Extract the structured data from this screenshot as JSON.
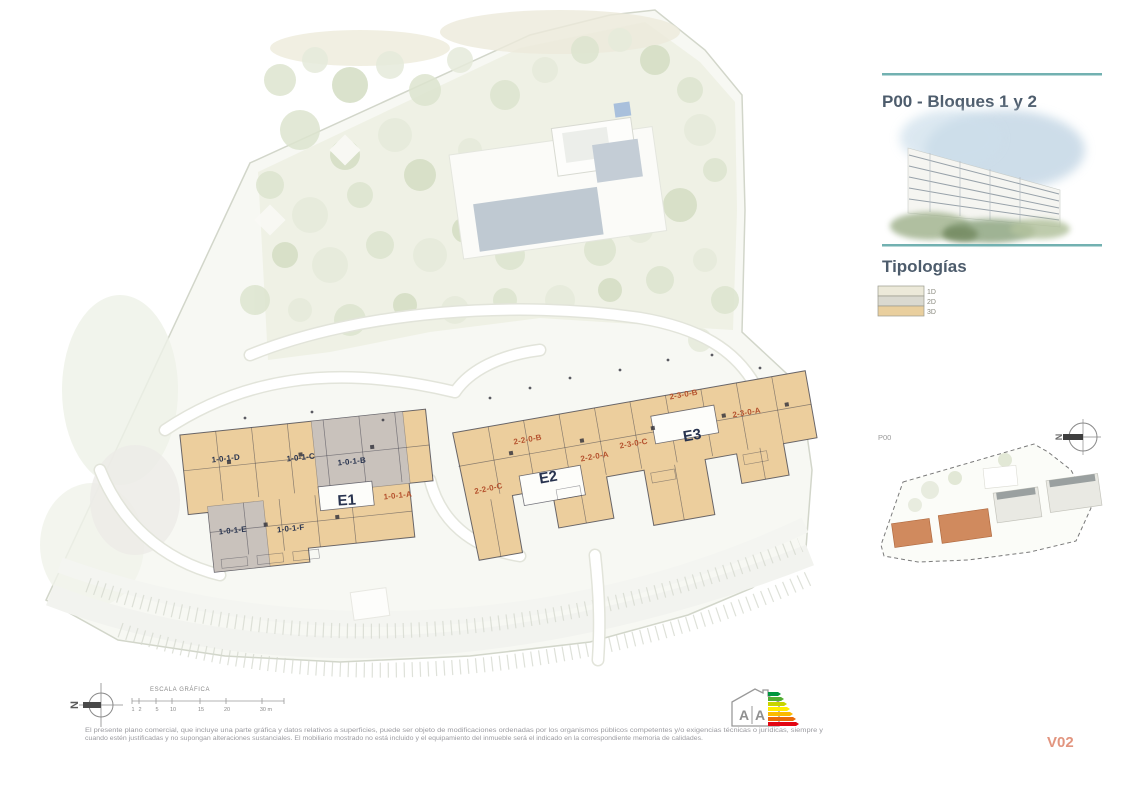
{
  "sheet": {
    "title": "P00 - Bloques 1 y 2",
    "typologies_heading": "Tipologías",
    "legend": [
      {
        "label": "1D",
        "color": "#ece9d9"
      },
      {
        "label": "2D",
        "color": "#dad9d0"
      },
      {
        "label": "3D",
        "color": "#e9cf9e"
      }
    ],
    "locator_label": "P00",
    "compass_letter": "N",
    "version": "V02"
  },
  "plan": {
    "buildings": [
      {
        "name": "E1",
        "units": [
          "1-0-1-D",
          "1-0-1-C",
          "1-0-1-B",
          "1-0-1-A",
          "1-0-1-E",
          "1-0-1-F"
        ]
      },
      {
        "name": "E2",
        "units": [
          "2-2-0-B",
          "2-2-0-A",
          "2-2-0-C"
        ]
      },
      {
        "name": "E3",
        "units": [
          "2-3-0-C",
          "2-3-0-B",
          "2-3-0-A"
        ]
      }
    ]
  },
  "scalebar": {
    "heading": "ESCALA GRÁFICA",
    "ticks": [
      "1",
      "2",
      "5",
      "10",
      "15",
      "20",
      "30 m"
    ]
  },
  "energy": {
    "left_letter": "A",
    "right_letter": "A",
    "colors": [
      "#009640",
      "#52ae32",
      "#c8d400",
      "#ffed00",
      "#fbba00",
      "#eb6909",
      "#e30613"
    ]
  },
  "disclaimer": {
    "line1": "El presente plano comercial, que incluye una parte gráfica y datos relativos a superficies, puede ser objeto de modificaciones ordenadas por los organismos públicos competentes y/o exigencias técnicas o jurídicas, siempre y",
    "line2": "cuando estén justificadas y no supongan alteraciones sustanciales. El mobiliario mostrado no está incluido y el equipamiento del inmueble será el indicado en la correspondiente memoria de calidades."
  },
  "colors": {
    "accent_teal": "#72b1b1",
    "heading": "#4d5c6c",
    "version_salmon": "#e2957f",
    "typology_tan": "#ecce9d",
    "building_gray": "#c9c2bc",
    "unit_label_navy": "#2a3550",
    "unit_label_red": "#b5522e",
    "locator_orange": "#d08a5e"
  }
}
